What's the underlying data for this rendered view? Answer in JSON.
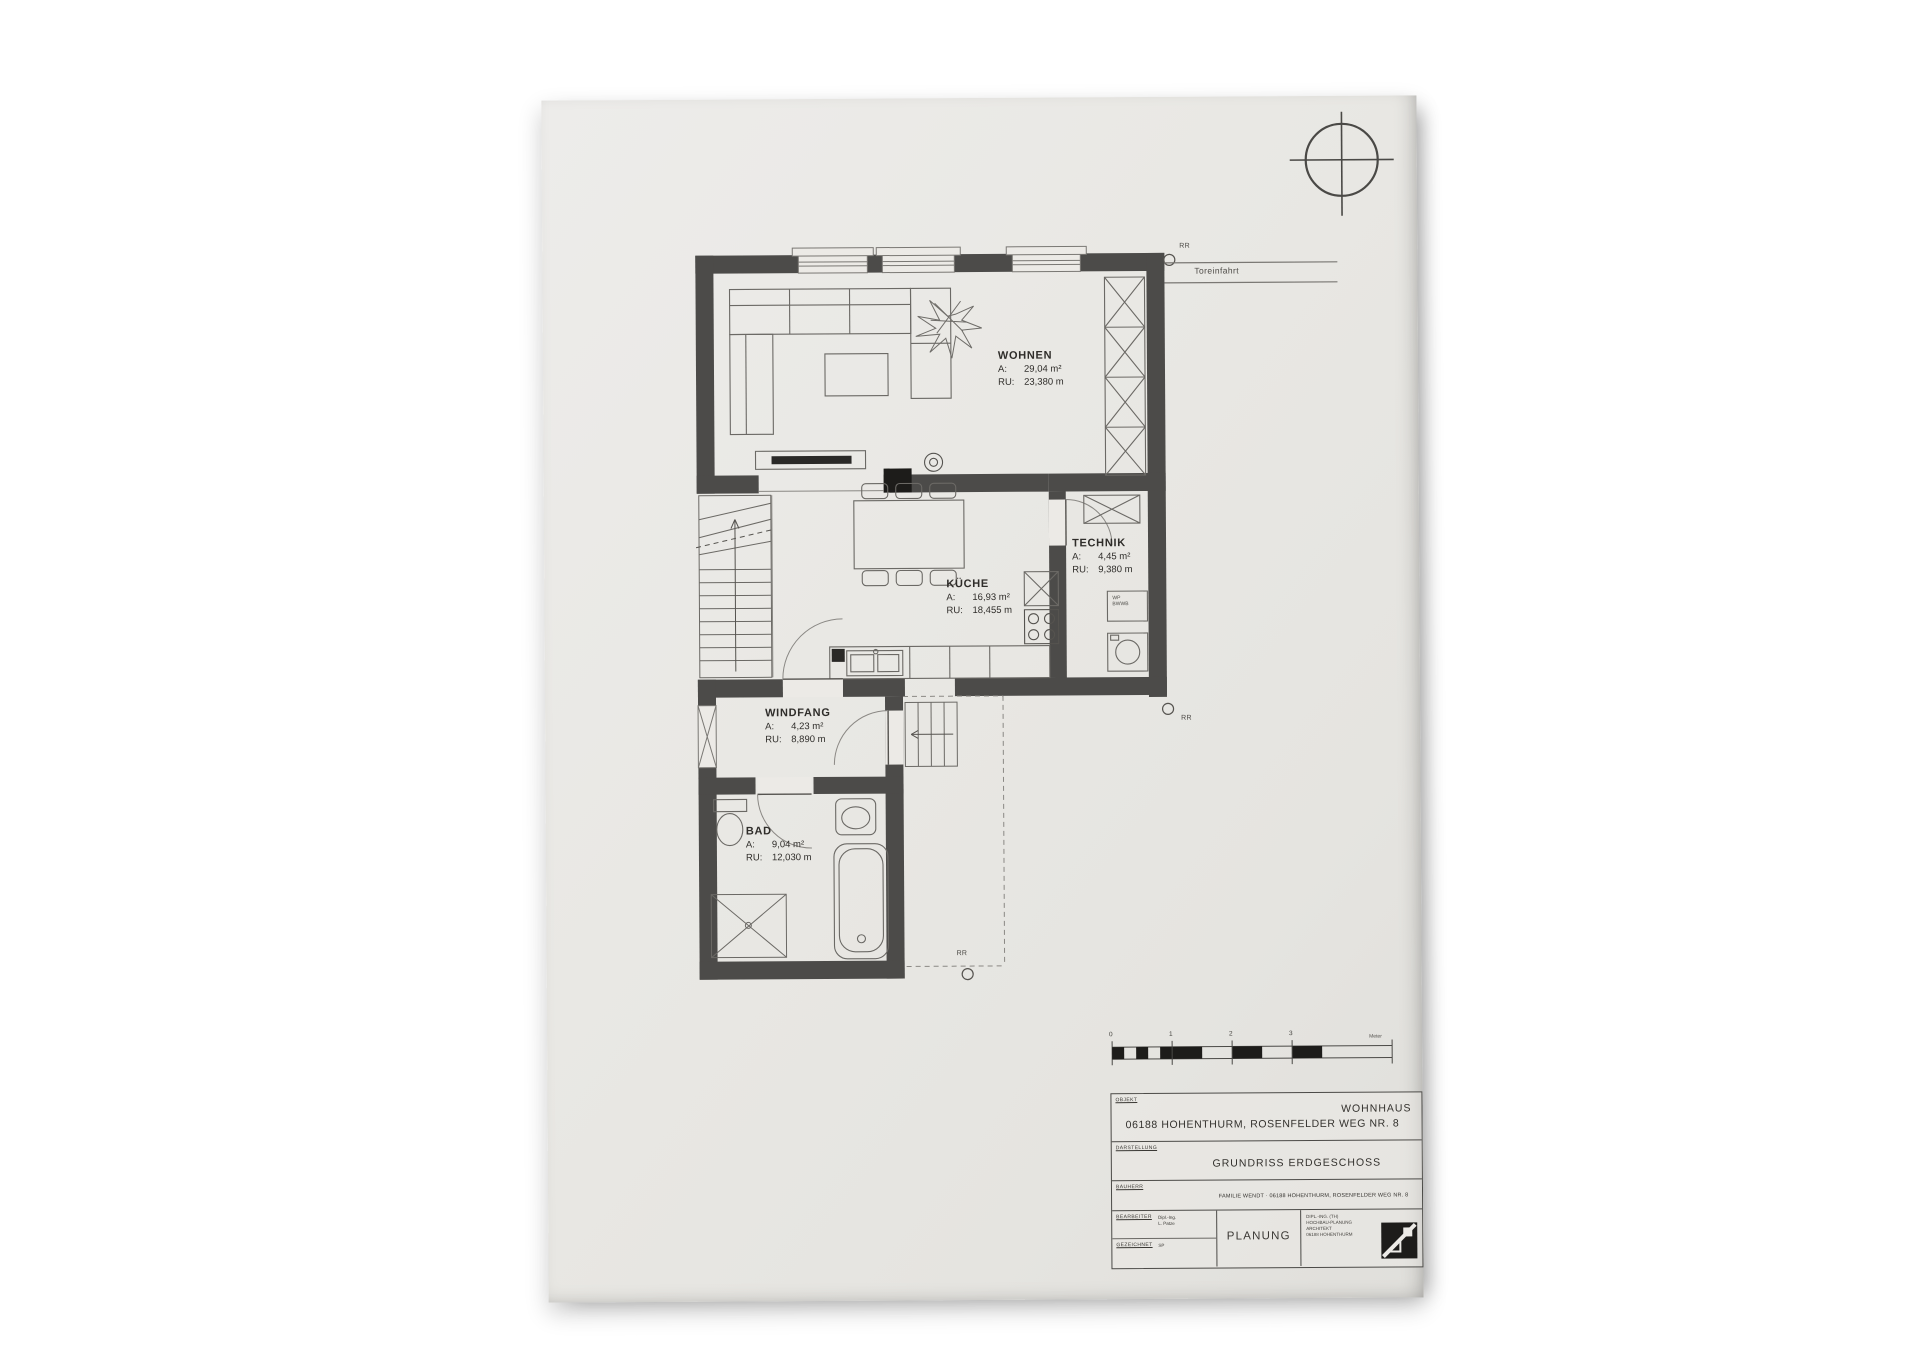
{
  "colors": {
    "paper": "#e9e8e4",
    "wall": "#4c4b49",
    "thin_line": "#8a8884",
    "fixture_line": "#55534f",
    "accent_black": "#1d1c1a"
  },
  "plan": {
    "rooms": [
      {
        "name": "WOHNEN",
        "a_label": "A:",
        "area": "29,04 m²",
        "ru_label": "RU:",
        "ru": "23,380 m"
      },
      {
        "name": "TECHNIK",
        "a_label": "A:",
        "area": "4,45 m²",
        "ru_label": "RU:",
        "ru": "9,380 m"
      },
      {
        "name": "KÜCHE",
        "a_label": "A:",
        "area": "16,93 m²",
        "ru_label": "RU:",
        "ru": "18,455 m"
      },
      {
        "name": "WINDFANG",
        "a_label": "A:",
        "area": "4,23 m²",
        "ru_label": "RU:",
        "ru": "8,890 m"
      },
      {
        "name": "BAD",
        "a_label": "A:",
        "area": "9,04 m²",
        "ru_label": "RU:",
        "ru": "12,030 m"
      }
    ],
    "annotations": {
      "toreinfahrt": "Toreinfahrt",
      "rr_top": "RR",
      "rr_right": "RR",
      "rr_bottom": "RR",
      "wp_line1": "WP",
      "wp_line2": "BWWB"
    },
    "scale_bar": {
      "tick0": "0",
      "tick1": "1",
      "tick2": "2",
      "tick3": "3",
      "unit": "Meter"
    }
  },
  "title_block": {
    "objekt_label": "OBJEKT",
    "objekt_line1": "WOHNHAUS",
    "objekt_line2": "06188 HOHENTHURM, ROSENFELDER WEG NR. 8",
    "darstellung_label": "DARSTELLUNG",
    "darstellung_value": "GRUNDRISS ERDGESCHOSS",
    "bauherr_label": "BAUHERR",
    "bauherr_value": "FAMILIE WENDT · 06188 HOHENTHURM, ROSENFELDER WEG NR. 8",
    "bearbeiter_label": "BEARBEITER",
    "bearbeiter_line1": "Dipl.-Ing.",
    "bearbeiter_line2": "L. Patze",
    "gezeichnet_label": "GEZEICHNET",
    "gezeichnet_value": "SP",
    "phase": "PLANUNG",
    "firm_line1": "DIPL.-ING. (TH)",
    "firm_line2": "HOCHBAU-PLANUNG",
    "firm_line3": "ARCHITEKT",
    "firm_line4": "06188 HOHENTHURM"
  }
}
